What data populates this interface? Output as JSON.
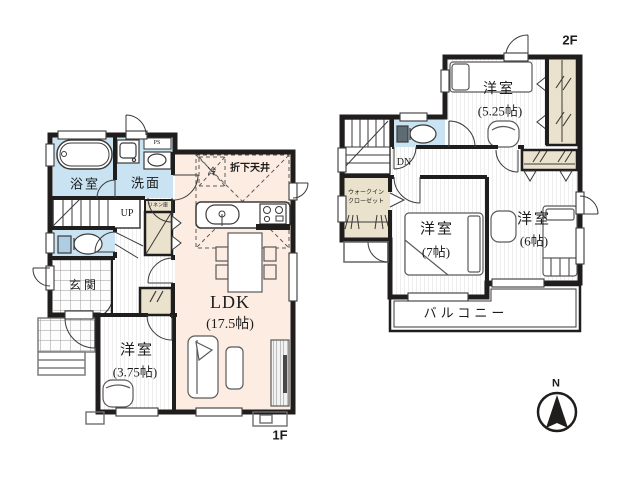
{
  "floor1": {
    "floor_label": "1F",
    "bath": "浴室",
    "washroom": "洗面",
    "entrance": "玄関",
    "bedroom_375": "洋室",
    "bedroom_375_size": "(3.75帖)",
    "ldk": "LDK",
    "ldk_size": "(17.5帖)",
    "stairs_up": "UP",
    "pipe_space": "PS",
    "linen": "リネン庫",
    "lowered_ceiling": "折下天井",
    "refrigerator": "冷"
  },
  "floor2": {
    "floor_label": "2F",
    "bedroom_525": "洋室",
    "bedroom_525_size": "(5.25帖)",
    "bedroom_7": "洋室",
    "bedroom_7_size": "(7帖)",
    "bedroom_6": "洋室",
    "bedroom_6_size": "(6帖)",
    "balcony": "バルコニー",
    "wic_line1": "ウォークイン",
    "wic_line2": "クローゼット",
    "stairs_down": "DN"
  },
  "compass": {
    "north": "N"
  },
  "colors": {
    "wall": "#201d1d",
    "water_room": "#c9e3f2",
    "ldk_floor": "#fcece2",
    "closet": "#eae2cc",
    "text": "#1c1c1c"
  }
}
